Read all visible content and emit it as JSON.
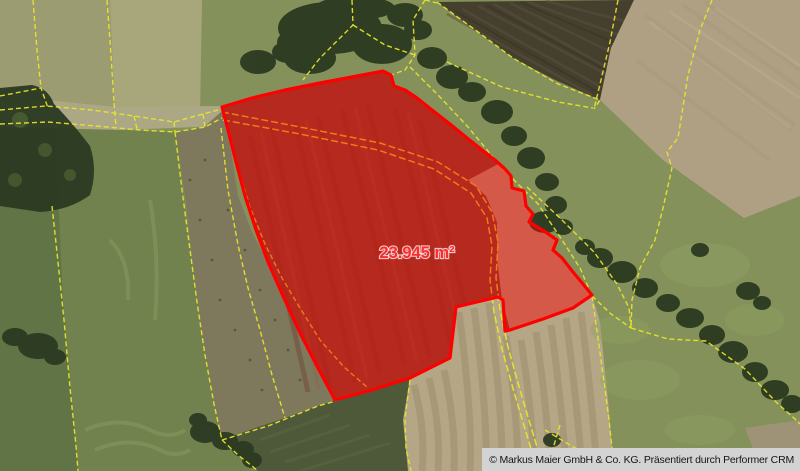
{
  "map": {
    "parcel": {
      "area_label": "23.945 m²"
    },
    "attribution": "© Markus Maier GmbH & Co. KG. Präsentiert durch Performer CRM"
  },
  "colors": {
    "parcel_red": "#ff0000",
    "parcel_label_red": "#ff2a2a",
    "cadastral_yellow": "#e8e62a",
    "track_orange_tint": "#f07b12",
    "attribution_bg": "#d3d3d3",
    "attribution_text": "#151515"
  }
}
